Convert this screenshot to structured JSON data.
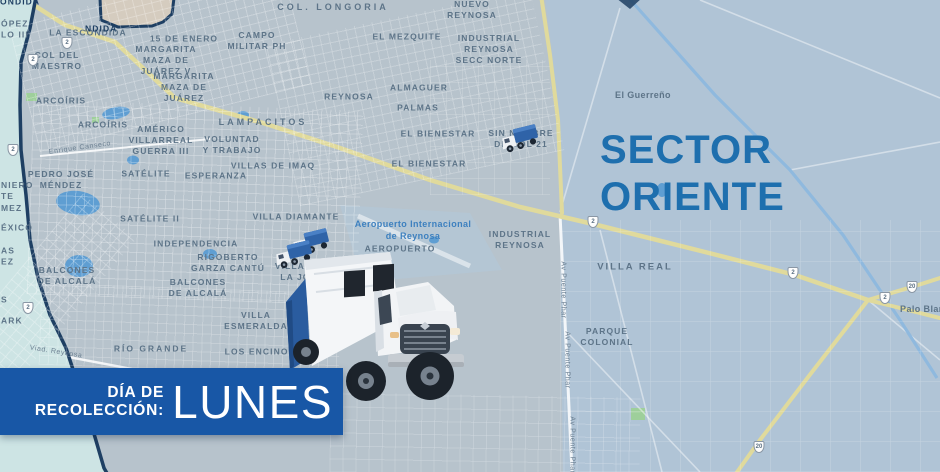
{
  "title": "Mapa de recolección de basura - Sector Oriente (Reynosa)",
  "sector": {
    "line1": "SECTOR",
    "line2": "ORIENTE"
  },
  "banner": {
    "label_line1": "DÍA DE",
    "label_line2": "RECOLECCIÓN:",
    "day": "LUNES",
    "bg_color": "#1857a6",
    "text_color": "#ffffff"
  },
  "colors": {
    "map_base": "#b7c3cc",
    "rural_east": "#b0c4d6",
    "adjacent_sector_west": "#cde4e4",
    "boundary_navy": "#1e3f63",
    "highway_yellow": "#e0da9c",
    "canal_blue": "#8fb9de",
    "label_gray_blue": "#5d7488",
    "airport_label_blue": "#3d80bf",
    "sector_title_blue": "#1e6fae",
    "adjacent_polygon_tan": "#d5ccbf"
  },
  "icons": {
    "truck_large": "garbage-truck-large-icon",
    "truck_small": "garbage-truck-small-icon",
    "highway_shield": "highway-shield-icon"
  },
  "map": {
    "labels": [
      {
        "lines": [
          "COL. LONGORIA"
        ],
        "x": 333,
        "y": 8,
        "fs": 9,
        "ls": 3
      },
      {
        "lines": [
          "NUEVO",
          "REYNOSA"
        ],
        "x": 472,
        "y": 10
      },
      {
        "lines": [
          "LA ESCONDIDA"
        ],
        "x": 88,
        "y": 33
      },
      {
        "lines": [
          "15 DE ENERO"
        ],
        "x": 184,
        "y": 39
      },
      {
        "lines": [
          "CAMPO",
          "MILITAR PH"
        ],
        "x": 257,
        "y": 41
      },
      {
        "lines": [
          "EL MEZQUITE"
        ],
        "x": 407,
        "y": 37
      },
      {
        "lines": [
          "INDUSTRIAL",
          "REYNOSA",
          "SECC NORTE"
        ],
        "x": 489,
        "y": 50
      },
      {
        "lines": [
          "COL DEL",
          "MAESTRO"
        ],
        "x": 57,
        "y": 61
      },
      {
        "lines": [
          "MARGARITA",
          "MAZA DE",
          "JUÁREZ V"
        ],
        "x": 166,
        "y": 61
      },
      {
        "lines": [
          "MARGARITA",
          "MAZA DE",
          "JUÁREZ"
        ],
        "x": 184,
        "y": 88
      },
      {
        "lines": [
          "ALMAGUER"
        ],
        "x": 419,
        "y": 88
      },
      {
        "lines": [
          "REYNOSA"
        ],
        "x": 349,
        "y": 97
      },
      {
        "lines": [
          "El Guerreño"
        ],
        "x": 643,
        "y": 96,
        "caps": false,
        "fs": 9
      },
      {
        "lines": [
          "ARCOÍRIS"
        ],
        "x": 61,
        "y": 101
      },
      {
        "lines": [
          "PALMAS"
        ],
        "x": 418,
        "y": 108
      },
      {
        "lines": [
          "LAMPACITOS"
        ],
        "x": 263,
        "y": 123,
        "fs": 9,
        "ls": 3
      },
      {
        "lines": [
          "ARCOÍRIS"
        ],
        "x": 103,
        "y": 125
      },
      {
        "lines": [
          "EL BIENESTAR"
        ],
        "x": 438,
        "y": 134
      },
      {
        "lines": [
          "SIN NOMBRE",
          "DE COL 21"
        ],
        "x": 521,
        "y": 139
      },
      {
        "lines": [
          "AMÉRICO",
          "VILLARREAL",
          "GUERRA III"
        ],
        "x": 161,
        "y": 141
      },
      {
        "lines": [
          "VOLUNTAD",
          "Y TRABAJO"
        ],
        "x": 232,
        "y": 145
      },
      {
        "lines": [
          "EL BIENESTAR"
        ],
        "x": 429,
        "y": 164
      },
      {
        "lines": [
          "VILLAS DE IMAQ"
        ],
        "x": 273,
        "y": 166
      },
      {
        "lines": [
          "SATÉLITE"
        ],
        "x": 146,
        "y": 174
      },
      {
        "lines": [
          "ESPERANZA"
        ],
        "x": 216,
        "y": 176
      },
      {
        "lines": [
          "PEDRO JOSÉ",
          "MÉNDEZ"
        ],
        "x": 61,
        "y": 180
      },
      {
        "lines": [
          "VILLA DIAMANTE"
        ],
        "x": 296,
        "y": 217
      },
      {
        "lines": [
          "SATÉLITE II"
        ],
        "x": 150,
        "y": 219
      },
      {
        "lines": [
          "Aeropuerto Internacional",
          "de Reynosa"
        ],
        "x": 413,
        "y": 231,
        "caps": false,
        "color": "#3d80bf",
        "fs": 9
      },
      {
        "lines": [
          "INDUSTRIAL",
          "REYNOSA"
        ],
        "x": 520,
        "y": 240
      },
      {
        "lines": [
          "INDEPENDENCIA"
        ],
        "x": 196,
        "y": 244
      },
      {
        "lines": [
          "AEROPUERTO"
        ],
        "x": 400,
        "y": 249
      },
      {
        "lines": [
          "RIGOBERTO",
          "GARZA CANTÚ"
        ],
        "x": 228,
        "y": 263
      },
      {
        "lines": [
          "VILLA REAL"
        ],
        "x": 635,
        "y": 268,
        "fs": 9.5,
        "ls": 2
      },
      {
        "lines": [
          "VILLAS DE",
          "LA JOYA"
        ],
        "x": 302,
        "y": 272
      },
      {
        "lines": [
          "BALCONES",
          "DE ALCALÁ"
        ],
        "x": 67,
        "y": 276
      },
      {
        "lines": [
          "BALCONES",
          "DE ALCALÁ"
        ],
        "x": 198,
        "y": 288
      },
      {
        "lines": [
          "VILLA",
          "ESMERALDA"
        ],
        "x": 256,
        "y": 321
      },
      {
        "lines": [
          "PARQUE",
          "COLONIAL"
        ],
        "x": 607,
        "y": 337
      },
      {
        "lines": [
          "RÍO GRANDE"
        ],
        "x": 151,
        "y": 349,
        "ls": 2
      },
      {
        "lines": [
          "LOS ENCINOS"
        ],
        "x": 260,
        "y": 352
      },
      {
        "lines": [
          "Palo Blanco"
        ],
        "x": 928,
        "y": 310,
        "caps": false,
        "fs": 9
      }
    ],
    "edge_fragments": [
      {
        "lines": [
          "ONDIDA"
        ],
        "x": 0,
        "y": 2,
        "navy": true
      },
      {
        "lines": [
          "NDIDA"
        ],
        "x": 85,
        "y": 29,
        "navy": true
      },
      {
        "lines": [
          "ÓPEZ",
          "LO III"
        ],
        "x": 1,
        "y": 30
      },
      {
        "lines": [
          "NIERO",
          "TE",
          "MEZ"
        ],
        "x": 1,
        "y": 197
      },
      {
        "lines": [
          "ÉXICO"
        ],
        "x": 1,
        "y": 228
      },
      {
        "lines": [
          "AS",
          "EZ"
        ],
        "x": 1,
        "y": 257
      },
      {
        "lines": [
          "S"
        ],
        "x": 1,
        "y": 300
      },
      {
        "lines": [
          "ARK"
        ],
        "x": 1,
        "y": 321
      }
    ],
    "street_labels": [
      {
        "text": "Enrique Canseco",
        "x": 80,
        "y": 148,
        "rot": -8
      },
      {
        "text": "Viad. Reynosa",
        "x": 56,
        "y": 352,
        "rot": 9
      },
      {
        "text": "Av Puente Phar",
        "x": 563,
        "y": 290,
        "rot": 90
      },
      {
        "text": "Av Puente Phar",
        "x": 567,
        "y": 360,
        "rot": 90
      },
      {
        "text": "Av Puente Phar",
        "x": 572,
        "y": 445,
        "rot": 90
      }
    ],
    "highway_shields": [
      {
        "x": 67,
        "y": 43,
        "num": "2"
      },
      {
        "x": 33,
        "y": 60,
        "num": "2"
      },
      {
        "x": 13,
        "y": 150,
        "num": "2"
      },
      {
        "x": 28,
        "y": 308,
        "num": "2"
      },
      {
        "x": 593,
        "y": 222,
        "num": "2"
      },
      {
        "x": 793,
        "y": 273,
        "num": "2"
      },
      {
        "x": 885,
        "y": 298,
        "num": "2"
      },
      {
        "x": 912,
        "y": 287,
        "num": "20"
      },
      {
        "x": 759,
        "y": 447,
        "num": "20"
      }
    ]
  }
}
